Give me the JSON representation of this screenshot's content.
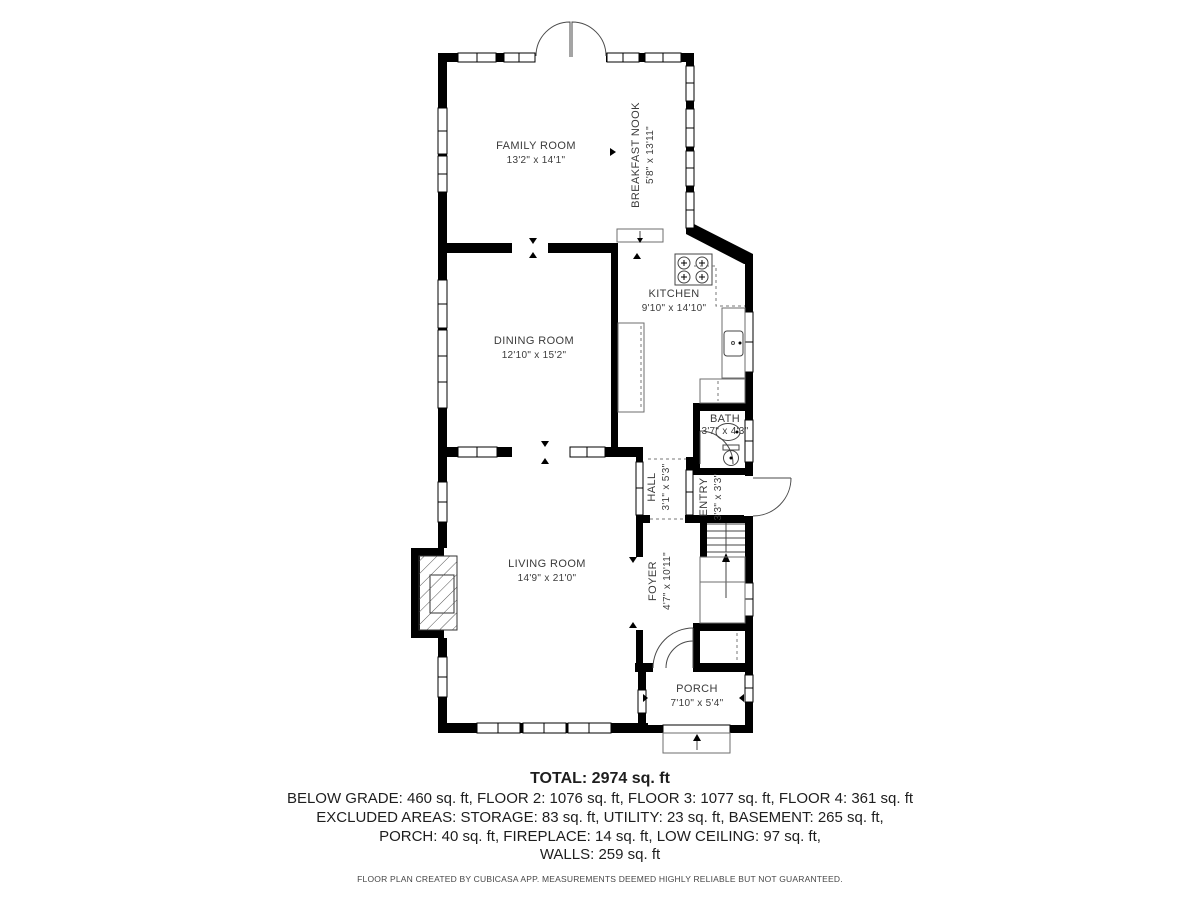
{
  "floor_plan": {
    "rooms": {
      "family_room": {
        "label": "FAMILY ROOM",
        "dims": "13'2\" x 14'1\""
      },
      "breakfast_nook": {
        "label": "BREAKFAST NOOK",
        "dims": "5'8\" x 13'11\""
      },
      "kitchen": {
        "label": "KITCHEN",
        "dims": "9'10\" x 14'10\""
      },
      "dining_room": {
        "label": "DINING ROOM",
        "dims": "12'10\" x 15'2\""
      },
      "bath": {
        "label": "BATH",
        "dims": "3'7\" x 4'3\""
      },
      "hall": {
        "label": "HALL",
        "dims": "3'1\" x 5'3\""
      },
      "entry": {
        "label": "ENTRY",
        "dims": "3'3\" x 3'3\""
      },
      "living_room": {
        "label": "LIVING ROOM",
        "dims": "14'9\" x 21'0\""
      },
      "foyer": {
        "label": "FOYER",
        "dims": "4'7\" x 10'11\""
      },
      "porch": {
        "label": "PORCH",
        "dims": "7'10\" x 5'4\""
      }
    },
    "colors": {
      "wall": "#000000",
      "label_text": "#3b3b3b",
      "summary_text": "#1e1e1e"
    }
  },
  "summary": {
    "total": "TOTAL: 2974 sq. ft",
    "line1": "BELOW GRADE: 460 sq. ft, FLOOR 2: 1076 sq. ft, FLOOR 3: 1077 sq. ft, FLOOR 4: 361 sq. ft",
    "line2": "EXCLUDED AREAS: STORAGE: 83 sq. ft, UTILITY: 23 sq. ft, BASEMENT: 265 sq. ft,",
    "line3": "PORCH: 40 sq. ft, FIREPLACE: 14 sq. ft, LOW CEILING: 97 sq. ft,",
    "line4": "WALLS: 259 sq. ft"
  },
  "footer": {
    "text": "FLOOR PLAN CREATED BY CUBICASA APP. MEASUREMENTS DEEMED HIGHLY RELIABLE BUT NOT GUARANTEED."
  }
}
